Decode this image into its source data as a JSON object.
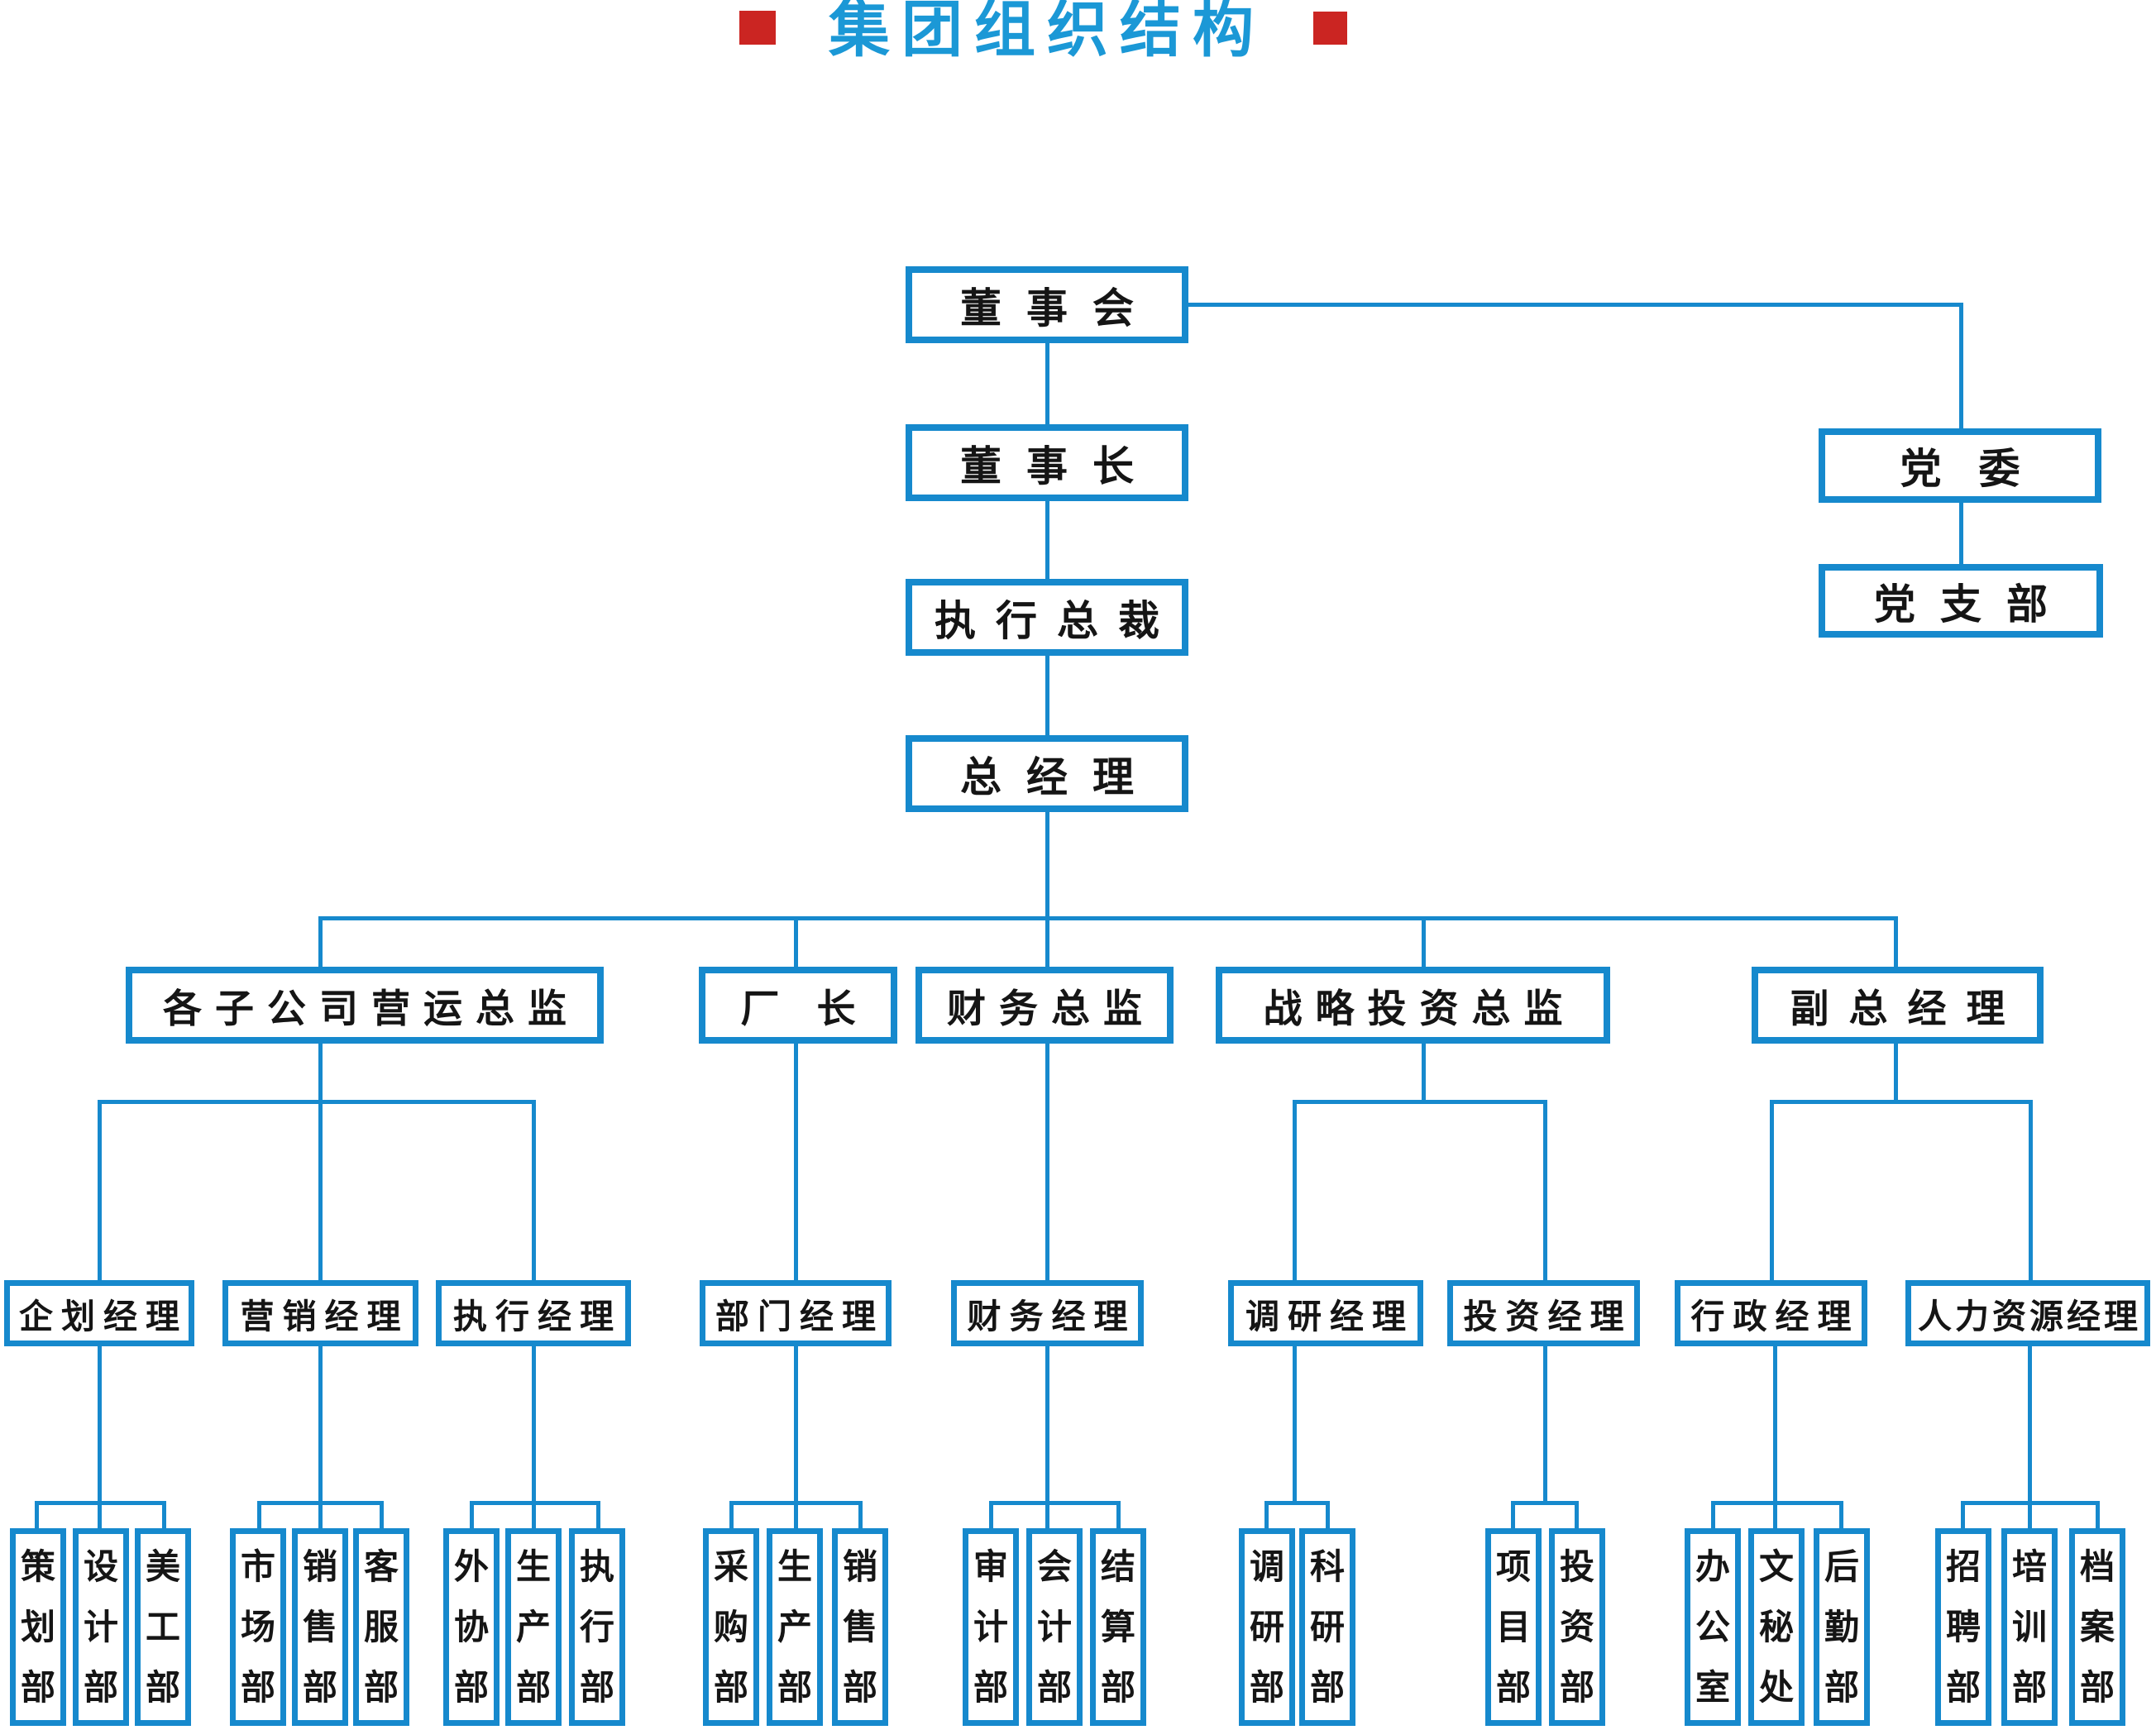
{
  "title": {
    "text": "集团组织结构"
  },
  "colors": {
    "line_blue": "#1689cd",
    "title_blue": "#1b98d6",
    "accent_red": "#cb2522",
    "text": "#151515"
  },
  "nodes": {
    "board": "董事会",
    "chairman": "董事长",
    "exec_president": "执行总裁",
    "general_manager": "总经理",
    "party_committee": "党委",
    "party_branch": "党支部",
    "subsidiary_ops_director": "各子公司营运总监",
    "factory_director": "厂长",
    "finance_director": "财务总监",
    "strategic_investment_director": "战略投资总监",
    "deputy_general_manager": "副总经理",
    "planning_manager": "企划经理",
    "marketing_manager": "营销经理",
    "execution_manager": "执行经理",
    "department_manager": "部门经理",
    "finance_manager": "财务经理",
    "research_manager": "调研经理",
    "investment_manager": "投资经理",
    "admin_manager": "行政经理",
    "hr_manager": "人力资源经理",
    "dept_planning": "策划部",
    "dept_design": "设计部",
    "dept_art": "美工部",
    "dept_market": "市场部",
    "dept_sales": "销售部",
    "dept_customer_service": "客服部",
    "dept_outsourcing": "外协部",
    "dept_production": "生产部",
    "dept_execution": "执行部",
    "dept_purchasing": "采购部",
    "dept_production2": "生产部",
    "dept_sales2": "销售部",
    "dept_audit": "审计部",
    "dept_accounting": "会计部",
    "dept_settlement": "结算部",
    "dept_research": "调研部",
    "dept_scientific_research": "科研部",
    "dept_project": "项目部",
    "dept_investment": "投资部",
    "dept_office": "办公室",
    "dept_secretary": "文秘处",
    "dept_logistics": "后勤部",
    "dept_recruitment": "招聘部",
    "dept_training": "培训部",
    "dept_archives": "档案部"
  }
}
